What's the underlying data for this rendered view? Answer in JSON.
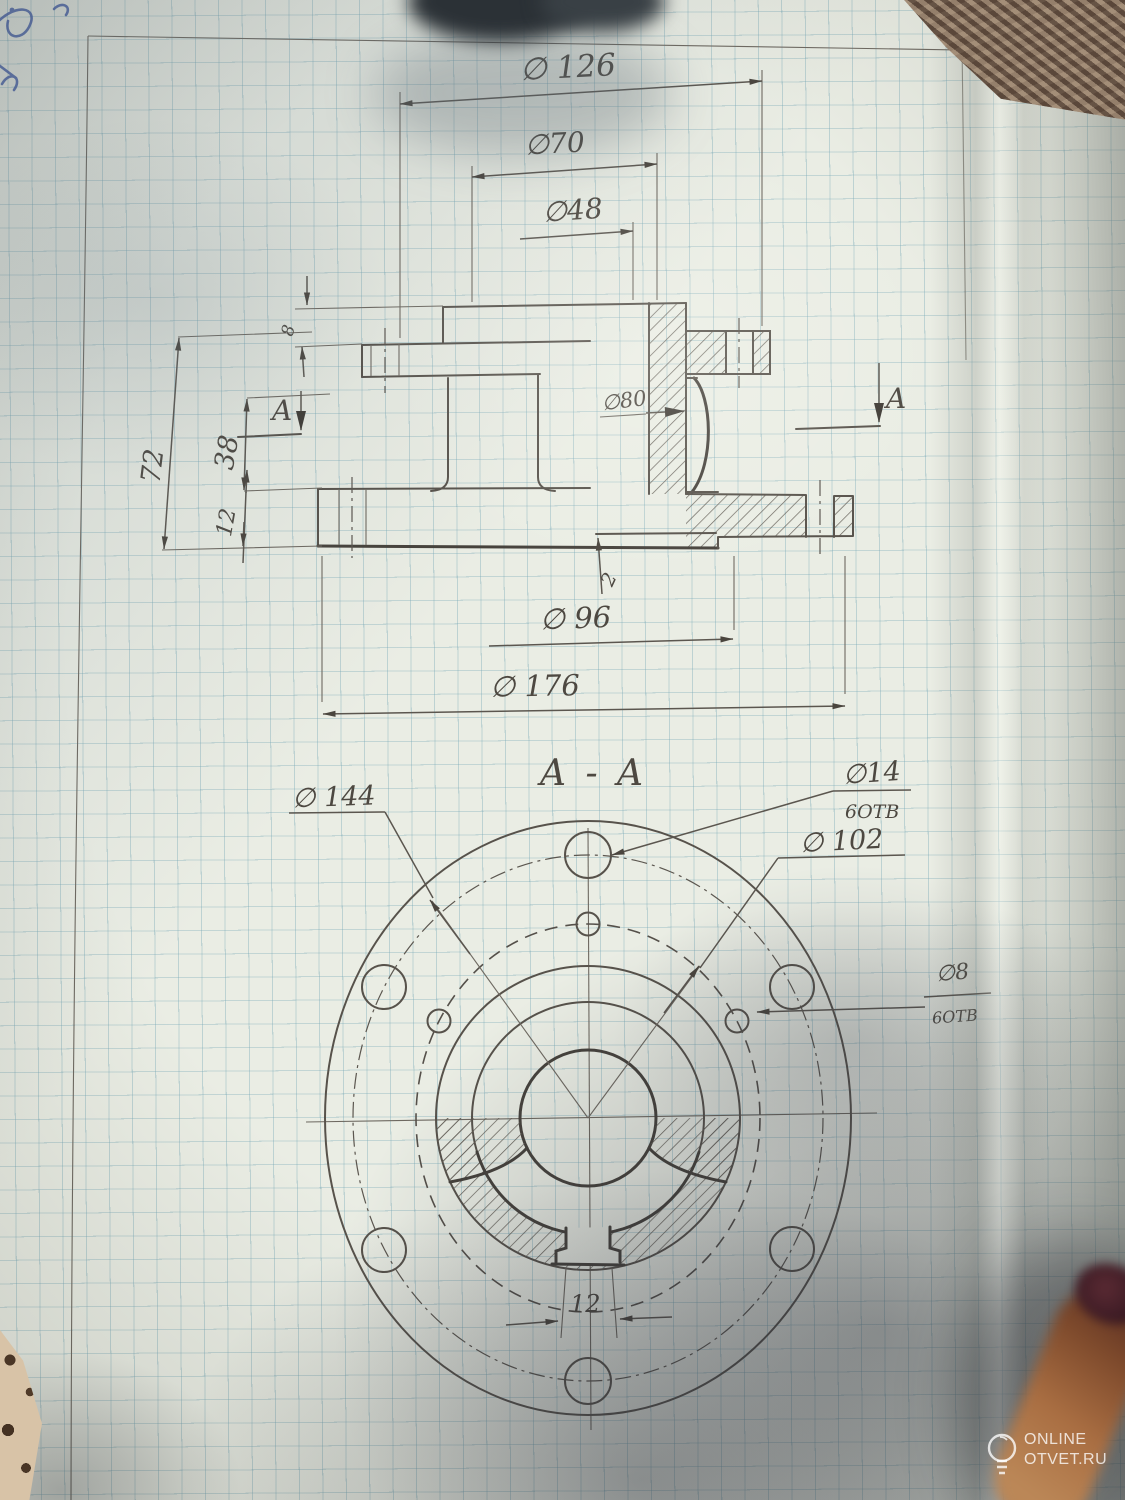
{
  "front_view": {
    "dia_126": "∅ 126",
    "dia_70": "∅70",
    "dia_48": "∅48",
    "dia_80": "∅80",
    "height_72": "72",
    "height_38": "38",
    "height_12": "12",
    "height_8": "8",
    "step_2": "2",
    "dia_96": "∅ 96",
    "dia_176": "∅ 176",
    "cut_label_left": "A",
    "cut_label_right": "A"
  },
  "section_view": {
    "title": "A - A",
    "dia_144": "∅ 144",
    "dia_14": "∅14",
    "dia_14_holes": "6ОТВ",
    "dia_102": "∅ 102",
    "dia_8": "∅8",
    "dia_8_holes": "6ОТВ",
    "keyway_12": "12"
  },
  "watermark": {
    "brand_line1": "ONLINE",
    "brand_line2": "OTVET.RU"
  },
  "colors": {
    "pencil": "#57524b",
    "grid": "#74a6b5",
    "paper": "#eaede4",
    "pen_ink": "#3b55a4"
  }
}
